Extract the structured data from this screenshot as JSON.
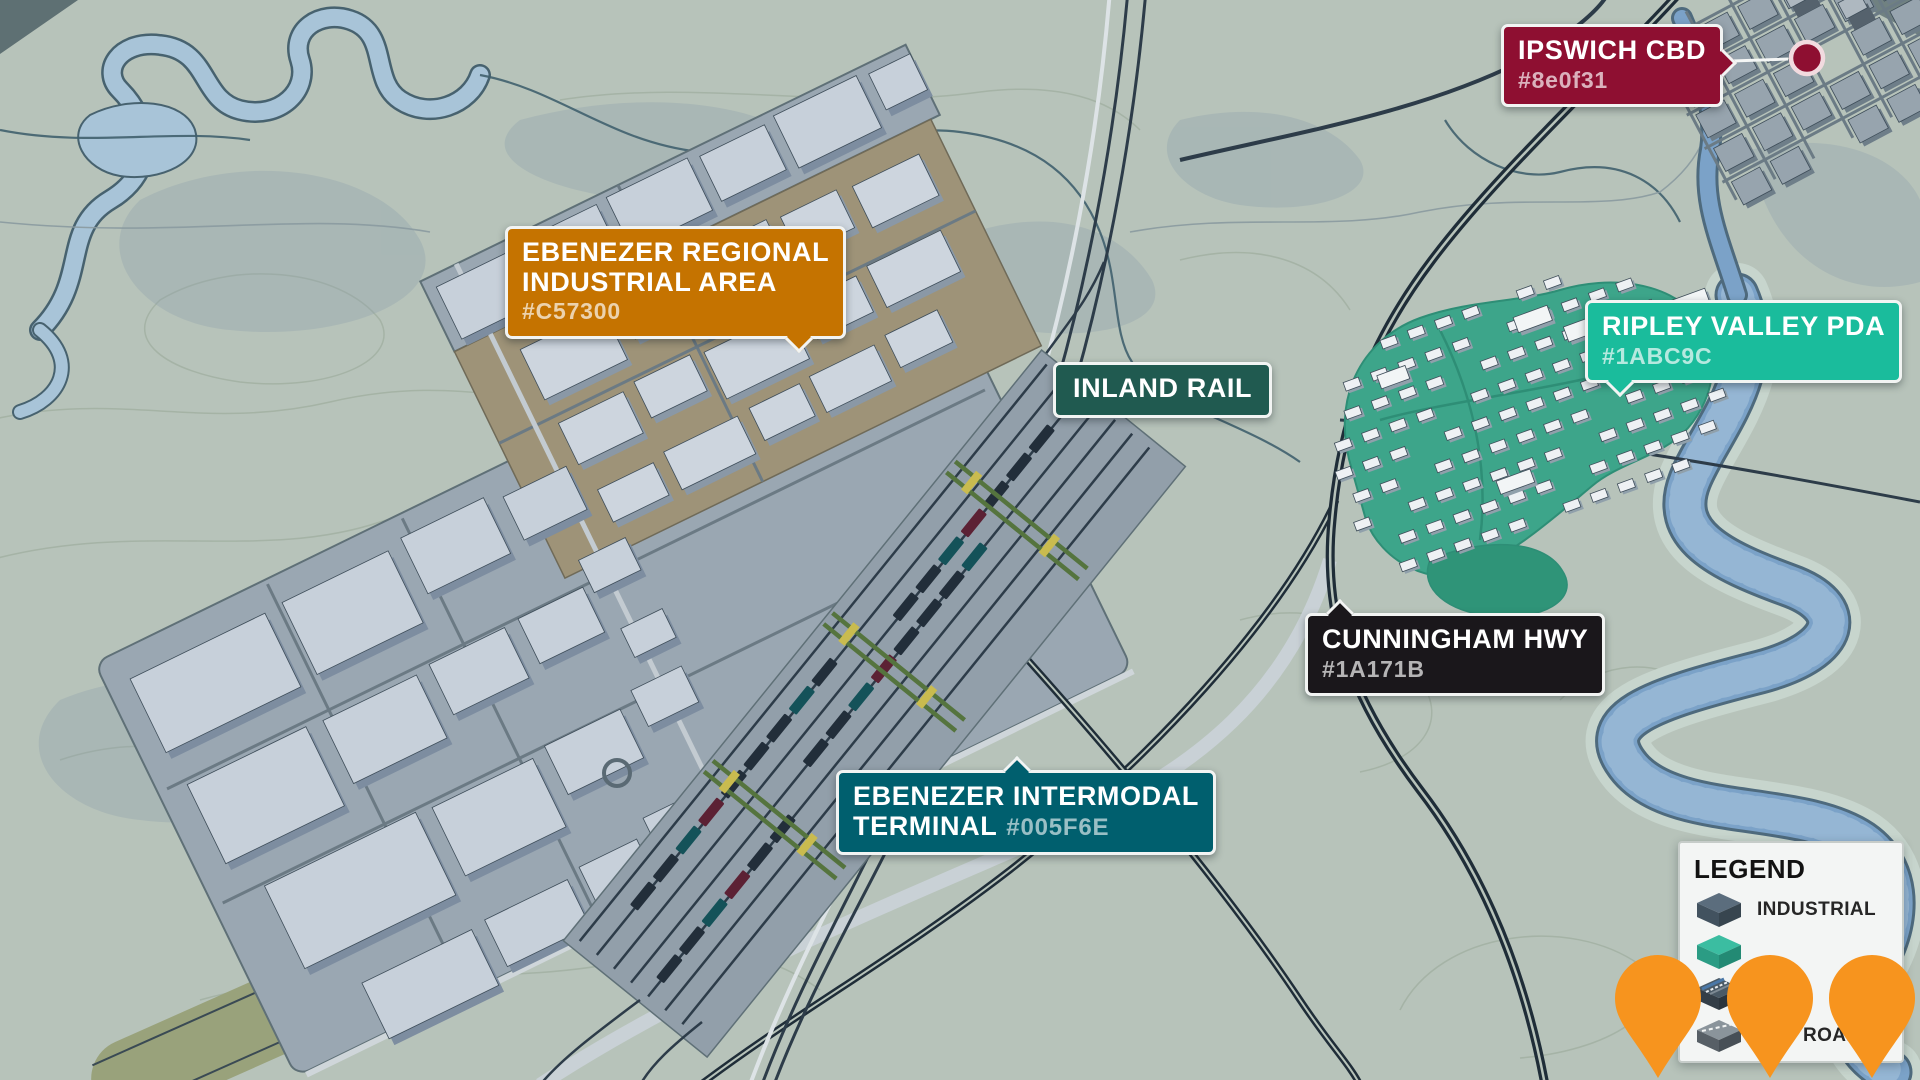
{
  "labels": {
    "ipswich_cbd": {
      "title": "IPSWICH CBD",
      "hex": "#8e0f31"
    },
    "ebenezer_regional": {
      "line1": "EBENEZER REGIONAL",
      "line2": "INDUSTRIAL AREA",
      "hex": "#C57300"
    },
    "inland_rail": {
      "title": "INLAND RAIL"
    },
    "ripley_valley": {
      "title": "RIPLEY VALLEY PDA",
      "hex": "#1ABC9C"
    },
    "cunningham_hwy": {
      "title": "CUNNINGHAM HWY",
      "hex": "#1A171B"
    },
    "intermodal_terminal": {
      "line1": "EBENEZER INTERMODAL",
      "line2": "TERMINAL",
      "hex": "#005F6E"
    }
  },
  "legend": {
    "title": "LEGEND",
    "items": [
      {
        "icon": "industrial-icon",
        "label": "INDUSTRIAL"
      },
      {
        "icon": "residential-icon",
        "label": "RESIDENTIAL"
      },
      {
        "icon": "rail-icon",
        "label": ""
      },
      {
        "icon": "road-icon",
        "label": "ROAD"
      }
    ]
  },
  "palette": {
    "terrain": "#B7C3BA",
    "contour": "#9FAE9F",
    "shadow": "#8BA0AC",
    "water": "#7BA2C8",
    "water_light": "#A8C4D8",
    "riverbank": "#C7D5CD",
    "platform": "#9AA7B2",
    "platform_edge": "#5F7077",
    "tan_zone": "#9E9378",
    "olive_strip": "#99A27B",
    "road_dark": "#1F2D38",
    "rail_dark": "#2D3C49",
    "road_light": "#C9D1D6",
    "building_top": "#C7D0DA",
    "building_side": "#7D8DA0",
    "residential_ground": "#3DA58A",
    "house_top": "#EEF1F4",
    "house_side": "#90A0AB",
    "cbd_block": "#97A4AE",
    "cbd_side": "#6E7E89",
    "crane": "#55743E",
    "crane_accent": "#C9BB4F",
    "train": "#222E3A",
    "train_teal": "#145259",
    "train_maroon": "#5C2134",
    "badge_ipswich": "#8E0F31",
    "badge_regional": "#C57300",
    "badge_inland": "#205A50",
    "badge_ripley": "#1ABC9C",
    "badge_cunningham": "#1A171B",
    "badge_terminal": "#005F6E",
    "pin": "#F7941E",
    "marker": "#8E0F31",
    "legend_bg": "#F3F5F4"
  }
}
